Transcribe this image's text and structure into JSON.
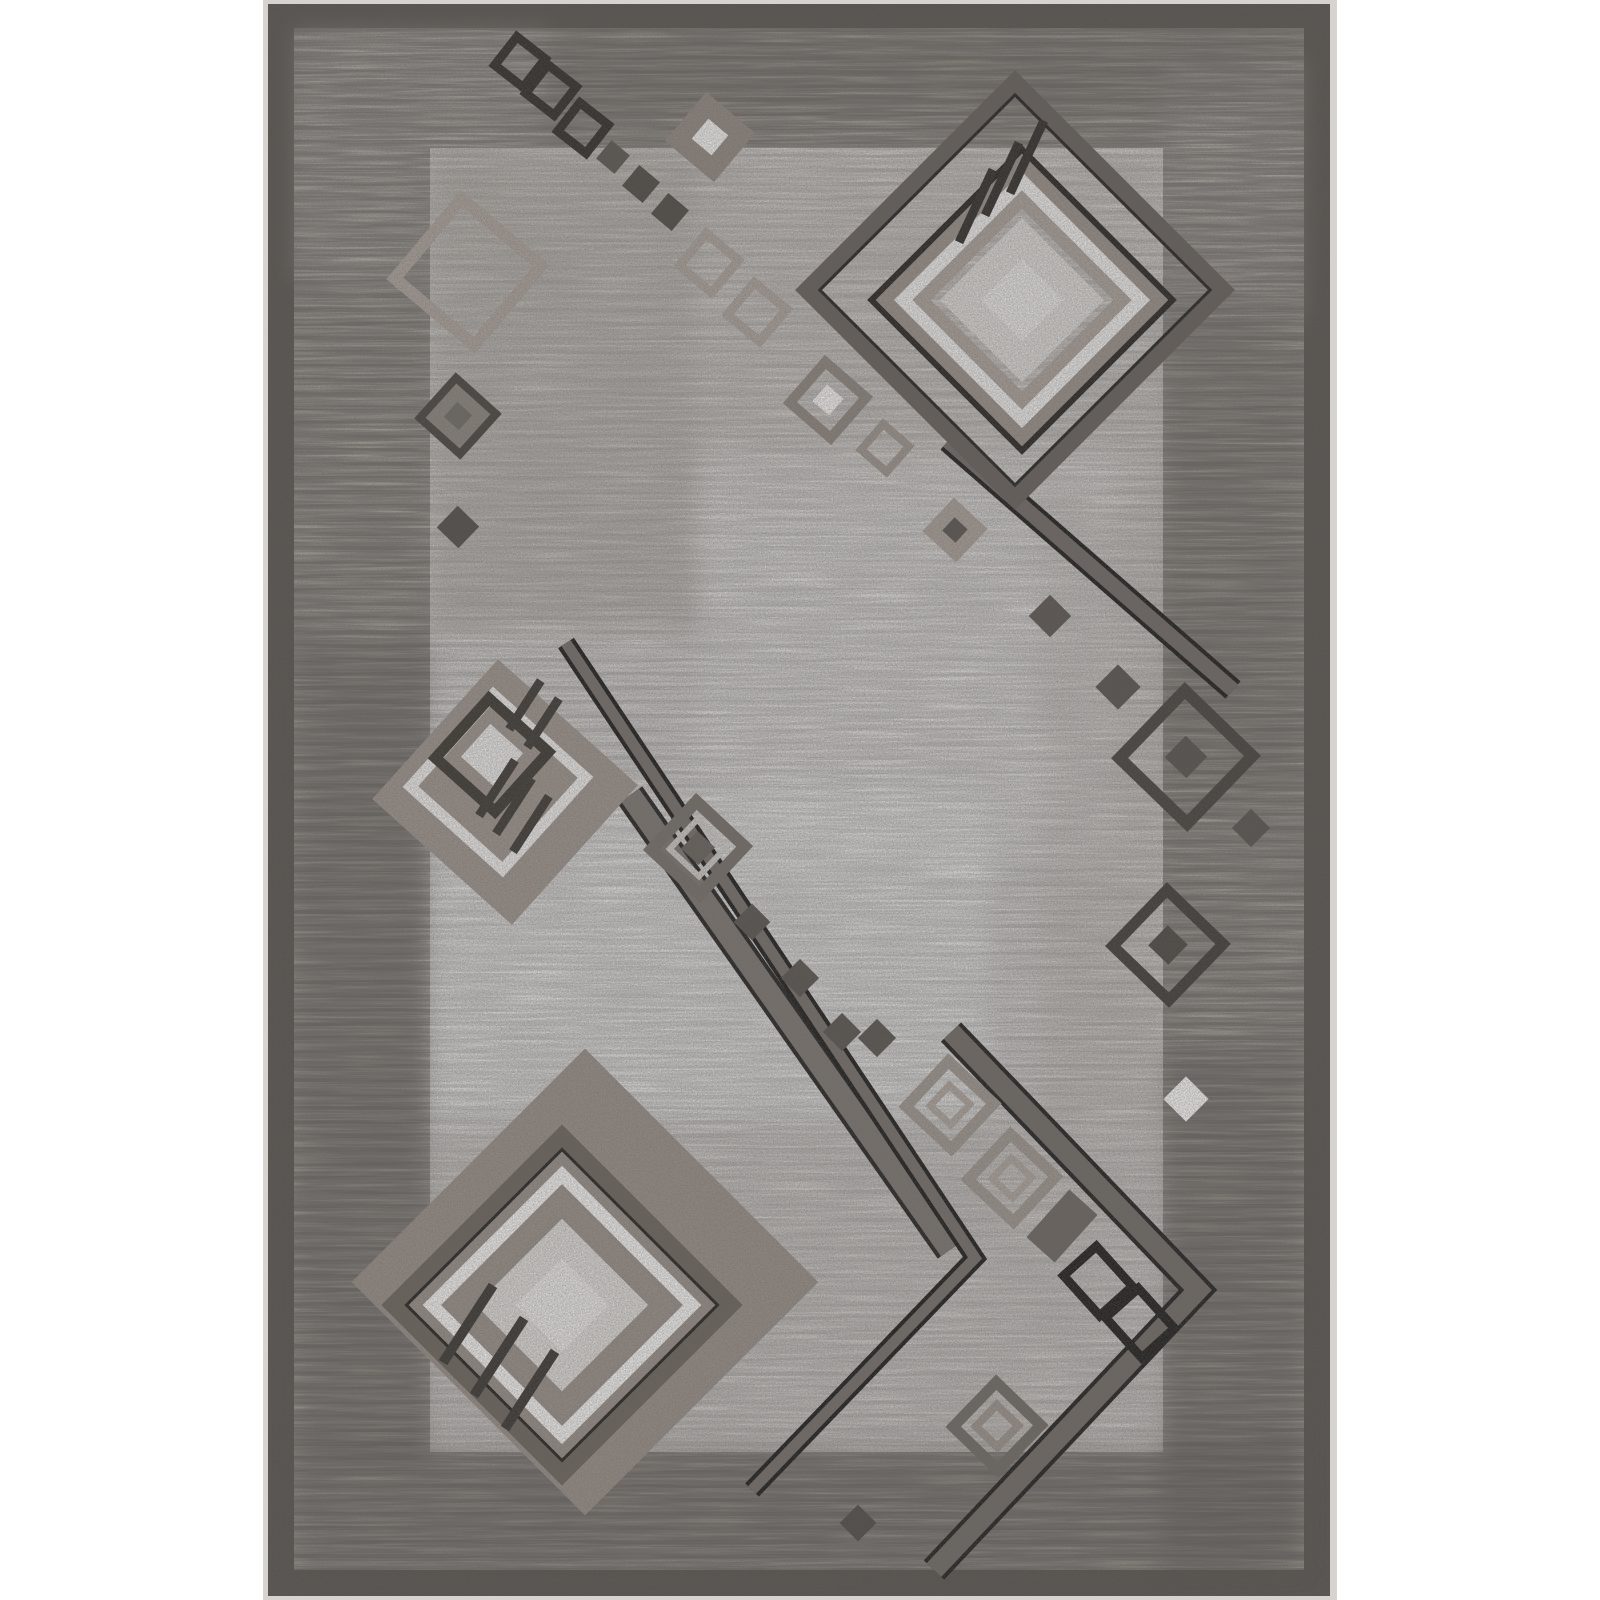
{
  "description": "Product photo of a rectangular gray and taupe area rug with a modern geometric pattern: nested concentric diamonds, chains of small squares, tick strokes and long diagonal chevron bands over a mottled light field, surrounded by a striated taupe border and dark binding edge.",
  "scene": {
    "width": 1600,
    "height": 1600,
    "palette": {
      "page_bg": "#ffffff",
      "photo_edge": "#d6d3d0",
      "binding": "#57524d",
      "border_base": "#a1988f",
      "field_base": "#dbd7d4",
      "stripe_dark": "#6f675f",
      "stripe_light": "#c9c2bc"
    },
    "layers": [
      {
        "name": "photo-edge",
        "x": 263,
        "y": 0,
        "w": 1074,
        "h": 1600,
        "fill": "#d6d3d0"
      },
      {
        "name": "binding",
        "x": 268,
        "y": 4,
        "w": 1062,
        "h": 1592,
        "fill": "#57524d"
      },
      {
        "name": "border",
        "x": 294,
        "y": 28,
        "w": 1010,
        "h": 1542,
        "fill": "#a1988f"
      },
      {
        "name": "field",
        "x": 430,
        "y": 148,
        "w": 733,
        "h": 1304,
        "fill": "#dbd7d4"
      }
    ],
    "stripes": [
      {
        "x": 294,
        "y": 28,
        "w": 1010,
        "h": 120,
        "op": 1
      },
      {
        "x": 294,
        "y": 1452,
        "w": 1010,
        "h": 118,
        "op": 1
      },
      {
        "x": 294,
        "y": 148,
        "w": 136,
        "h": 1304,
        "op": 1
      },
      {
        "x": 1163,
        "y": 148,
        "w": 141,
        "h": 1304,
        "op": 1
      },
      {
        "x": 430,
        "y": 148,
        "w": 733,
        "h": 1304,
        "op": 0.45
      }
    ],
    "patches": [
      {
        "x": 540,
        "y": 30,
        "w": 762,
        "h": 82,
        "fill": "#5f5850",
        "op": 0.28
      },
      {
        "x": 296,
        "y": 30,
        "w": 250,
        "h": 250,
        "fill": "#cfc9c4",
        "op": 0.25
      },
      {
        "x": 296,
        "y": 640,
        "w": 134,
        "h": 820,
        "fill": "#564f48",
        "op": 0.3
      },
      {
        "x": 1163,
        "y": 60,
        "w": 139,
        "h": 260,
        "fill": "#cfc9c4",
        "op": 0.22
      },
      {
        "x": 1163,
        "y": 300,
        "w": 139,
        "h": 500,
        "fill": "#5f5850",
        "op": 0.22
      },
      {
        "x": 1163,
        "y": 1050,
        "w": 139,
        "h": 520,
        "fill": "#544d46",
        "op": 0.3
      },
      {
        "x": 296,
        "y": 1440,
        "w": 1006,
        "h": 130,
        "fill": "#574f48",
        "op": 0.3
      },
      {
        "x": 430,
        "y": 148,
        "w": 270,
        "h": 480,
        "fill": "#b3aaa3",
        "op": 0.55
      },
      {
        "x": 700,
        "y": 148,
        "w": 463,
        "h": 360,
        "fill": "#c3bbb4",
        "op": 0.4
      },
      {
        "x": 700,
        "y": 450,
        "w": 420,
        "h": 420,
        "fill": "#e8e5e3",
        "op": 0.5
      },
      {
        "x": 430,
        "y": 790,
        "w": 560,
        "h": 330,
        "fill": "#f0efed",
        "op": 0.6
      },
      {
        "x": 430,
        "y": 1120,
        "w": 733,
        "h": 332,
        "fill": "#c9c3bf",
        "op": 0.45
      },
      {
        "x": 1040,
        "y": 500,
        "w": 123,
        "h": 620,
        "fill": "#b9b1aa",
        "op": 0.3
      }
    ],
    "speckle": [
      {
        "x": 294,
        "y": 28,
        "w": 1010,
        "h": 120,
        "op": 0.5
      },
      {
        "x": 294,
        "y": 1452,
        "w": 1010,
        "h": 118,
        "op": 0.5
      },
      {
        "x": 294,
        "y": 148,
        "w": 136,
        "h": 1304,
        "op": 0.5
      },
      {
        "x": 1163,
        "y": 148,
        "w": 141,
        "h": 1304,
        "op": 0.5
      },
      {
        "x": 430,
        "y": 148,
        "w": 733,
        "h": 1304,
        "op": 0.22
      }
    ],
    "grain": {
      "x": 268,
      "y": 4,
      "w": 1062,
      "h": 1592,
      "op": 0.5
    },
    "motifs": [
      {
        "k": "rect",
        "cx": 585,
        "cy": 1282,
        "w": 330,
        "h": 330,
        "rot": 45,
        "fill": "#958b84"
      },
      {
        "k": "rect",
        "cx": 562,
        "cy": 1305,
        "w": 252,
        "h": 252,
        "rot": 45,
        "stroke": "#23201d",
        "sw": 3
      },
      {
        "k": "rect",
        "cx": 562,
        "cy": 1305,
        "w": 236,
        "h": 236,
        "rot": 45,
        "stroke": "#696259",
        "sw": 19
      },
      {
        "k": "rect",
        "cx": 562,
        "cy": 1305,
        "w": 220,
        "h": 220,
        "rot": 45,
        "stroke": "#23201d",
        "sw": 3
      },
      {
        "k": "rect",
        "cx": 562,
        "cy": 1305,
        "w": 184,
        "h": 184,
        "rot": 45,
        "stroke": "#f0eeec",
        "sw": 13
      },
      {
        "k": "rect",
        "cx": 562,
        "cy": 1305,
        "w": 150,
        "h": 150,
        "rot": 45,
        "stroke": "#968c85",
        "sw": 12
      },
      {
        "k": "rect",
        "cx": 562,
        "cy": 1305,
        "w": 122,
        "h": 122,
        "rot": 45,
        "fill": "#dad6d3"
      },
      {
        "k": "rect",
        "cx": 562,
        "cy": 1305,
        "w": 66,
        "h": 66,
        "rot": 45,
        "fill": "#e7e4e2"
      },
      {
        "k": "rect",
        "cx": 468,
        "cy": 1324,
        "w": 10,
        "h": 92,
        "rot": 33,
        "fill": "#38332f"
      },
      {
        "k": "rect",
        "cx": 499,
        "cy": 1357,
        "w": 10,
        "h": 92,
        "rot": 33,
        "fill": "#38332f"
      },
      {
        "k": "rect",
        "cx": 530,
        "cy": 1390,
        "w": 10,
        "h": 92,
        "rot": 33,
        "fill": "#38332f"
      },
      {
        "k": "band",
        "pts": [
          [
            630,
            795
          ],
          [
            950,
            1250
          ]
        ],
        "w": 30,
        "cw": 22,
        "edge": "#23201f",
        "core": "#7a736d"
      },
      {
        "k": "band",
        "pts": [
          [
            951,
            1032
          ],
          [
            1198,
            1290
          ],
          [
            934,
            1570
          ]
        ],
        "w": 28,
        "cw": 20,
        "edge": "#201d1b",
        "core": "#6f6862"
      },
      {
        "k": "band",
        "pts": [
          [
            566,
            643
          ],
          [
            975,
            1258
          ],
          [
            752,
            1490
          ]
        ],
        "w": 19,
        "cw": 11,
        "edge": "#1b1917",
        "core": "#736c66"
      },
      {
        "k": "band",
        "pts": [
          [
            948,
            441
          ],
          [
            1233,
            690
          ]
        ],
        "w": 23,
        "cw": 15,
        "edge": "#1d1a18",
        "core": "#6e6762"
      },
      {
        "k": "rect",
        "cx": 505,
        "cy": 792,
        "w": 188,
        "h": 188,
        "rot": 42,
        "fill": "#9a9089"
      },
      {
        "k": "rect",
        "cx": 498,
        "cy": 782,
        "w": 124,
        "h": 124,
        "rot": 42,
        "stroke": "#eae7e5",
        "sw": 11
      },
      {
        "k": "rect",
        "cx": 492,
        "cy": 755,
        "w": 80,
        "h": 80,
        "rot": 42,
        "stroke": "#3a352f",
        "sw": 11
      },
      {
        "k": "rect",
        "cx": 492,
        "cy": 755,
        "w": 44,
        "h": 44,
        "rot": 42,
        "fill": "#e6e3e1"
      },
      {
        "k": "rect",
        "cx": 525,
        "cy": 705,
        "w": 9,
        "h": 58,
        "rot": 33,
        "fill": "#3b3631"
      },
      {
        "k": "rect",
        "cx": 543,
        "cy": 723,
        "w": 9,
        "h": 58,
        "rot": 33,
        "fill": "#3b3631"
      },
      {
        "k": "rect",
        "cx": 497,
        "cy": 788,
        "w": 9,
        "h": 66,
        "rot": 33,
        "fill": "#3b3631"
      },
      {
        "k": "rect",
        "cx": 514,
        "cy": 806,
        "w": 9,
        "h": 66,
        "rot": 33,
        "fill": "#3b3631"
      },
      {
        "k": "rect",
        "cx": 531,
        "cy": 824,
        "w": 9,
        "h": 66,
        "rot": 33,
        "fill": "#3b3631"
      },
      {
        "k": "rect",
        "cx": 698,
        "cy": 848,
        "w": 66,
        "h": 66,
        "rot": 43,
        "stroke": "#746d67",
        "sw": 12
      },
      {
        "k": "rect",
        "cx": 698,
        "cy": 848,
        "w": 40,
        "h": 40,
        "rot": 43,
        "stroke": "#cbc6c2",
        "sw": 6
      },
      {
        "k": "rect",
        "cx": 698,
        "cy": 848,
        "w": 24,
        "h": 24,
        "rot": 43,
        "fill": "#665f59"
      },
      {
        "k": "rect",
        "cx": 752,
        "cy": 922,
        "w": 26,
        "h": 26,
        "rot": 45,
        "fill": "#57514c"
      },
      {
        "k": "rect",
        "cx": 800,
        "cy": 978,
        "w": 27,
        "h": 27,
        "rot": 45,
        "fill": "#57514c"
      },
      {
        "k": "rect",
        "cx": 842,
        "cy": 1032,
        "w": 27,
        "h": 27,
        "rot": 45,
        "fill": "#57514c"
      },
      {
        "k": "rect",
        "cx": 950,
        "cy": 1105,
        "w": 62,
        "h": 62,
        "rot": 43,
        "stroke": "#9c938c",
        "sw": 11
      },
      {
        "k": "rect",
        "cx": 950,
        "cy": 1105,
        "w": 28,
        "h": 28,
        "rot": 43,
        "stroke": "#aba199",
        "sw": 7
      },
      {
        "k": "rect",
        "cx": 1012,
        "cy": 1178,
        "w": 62,
        "h": 62,
        "rot": 43,
        "stroke": "#9c938c",
        "sw": 11
      },
      {
        "k": "rect",
        "cx": 1012,
        "cy": 1178,
        "w": 28,
        "h": 28,
        "rot": 43,
        "stroke": "#aba199",
        "sw": 7
      },
      {
        "k": "rect",
        "cx": 1062,
        "cy": 1226,
        "w": 64,
        "h": 38,
        "rot": -48,
        "fill": "#6b645e"
      },
      {
        "k": "rect",
        "cx": 1098,
        "cy": 1281,
        "w": 44,
        "h": 54,
        "rot": -42,
        "stroke": "#1d1b19",
        "sw": 9
      },
      {
        "k": "rect",
        "cx": 1140,
        "cy": 1323,
        "w": 44,
        "h": 54,
        "rot": -42,
        "stroke": "#1d1b19",
        "sw": 9
      },
      {
        "k": "rect",
        "cx": 997,
        "cy": 1426,
        "w": 62,
        "h": 62,
        "rot": 44,
        "stroke": "#6f6862",
        "sw": 11
      },
      {
        "k": "rect",
        "cx": 997,
        "cy": 1426,
        "w": 30,
        "h": 30,
        "rot": 44,
        "stroke": "#9a9089",
        "sw": 8
      },
      {
        "k": "rect",
        "cx": 858,
        "cy": 1523,
        "w": 26,
        "h": 26,
        "rot": 45,
        "fill": "#4f4a45"
      },
      {
        "k": "rect",
        "cx": 1050,
        "cy": 616,
        "w": 30,
        "h": 30,
        "rot": 45,
        "fill": "#5b544f"
      },
      {
        "k": "rect",
        "cx": 1118,
        "cy": 687,
        "w": 32,
        "h": 32,
        "rot": 45,
        "fill": "#57514c"
      },
      {
        "k": "rect",
        "cx": 1186,
        "cy": 757,
        "w": 94,
        "h": 94,
        "rot": 44,
        "stroke": "#45403b",
        "sw": 12
      },
      {
        "k": "rect",
        "cx": 1186,
        "cy": 757,
        "w": 30,
        "h": 30,
        "rot": 44,
        "fill": "#55504b"
      },
      {
        "k": "rect",
        "cx": 1251,
        "cy": 828,
        "w": 27,
        "h": 27,
        "rot": 45,
        "fill": "#57514c"
      },
      {
        "k": "rect",
        "cx": 1168,
        "cy": 945,
        "w": 78,
        "h": 78,
        "rot": 44,
        "stroke": "#3f3a36",
        "sw": 11
      },
      {
        "k": "rect",
        "cx": 1168,
        "cy": 945,
        "w": 28,
        "h": 28,
        "rot": 44,
        "fill": "#4c4641"
      },
      {
        "k": "rect",
        "cx": 1186,
        "cy": 1099,
        "w": 32,
        "h": 32,
        "rot": 45,
        "fill": "#f2f0ee"
      },
      {
        "k": "rect",
        "cx": 877,
        "cy": 1038,
        "w": 27,
        "h": 27,
        "rot": 45,
        "fill": "#57514c"
      },
      {
        "k": "rect",
        "cx": 828,
        "cy": 400,
        "w": 54,
        "h": 54,
        "rot": 41,
        "stroke": "#8a817a",
        "sw": 10
      },
      {
        "k": "rect",
        "cx": 828,
        "cy": 400,
        "w": 22,
        "h": 22,
        "rot": 41,
        "fill": "#eeecea"
      },
      {
        "k": "rect",
        "cx": 885,
        "cy": 448,
        "w": 34,
        "h": 34,
        "rot": 41,
        "stroke": "#9a9089",
        "sw": 8
      },
      {
        "k": "rect",
        "cx": 955,
        "cy": 530,
        "w": 46,
        "h": 46,
        "rot": 43,
        "fill": "#a59b94"
      },
      {
        "k": "rect",
        "cx": 955,
        "cy": 530,
        "w": 18,
        "h": 18,
        "rot": 43,
        "fill": "#57514c"
      },
      {
        "k": "rect",
        "cx": 520,
        "cy": 62,
        "w": 36,
        "h": 36,
        "rot": 38,
        "stroke": "#2e2a27",
        "sw": 9
      },
      {
        "k": "rect",
        "cx": 551,
        "cy": 90,
        "w": 36,
        "h": 36,
        "rot": 38,
        "stroke": "#2e2a27",
        "sw": 9
      },
      {
        "k": "rect",
        "cx": 583,
        "cy": 128,
        "w": 36,
        "h": 36,
        "rot": 38,
        "stroke": "#2e2a27",
        "sw": 9
      },
      {
        "k": "rect",
        "cx": 613,
        "cy": 157,
        "w": 24,
        "h": 24,
        "rot": 40,
        "fill": "#5a544e"
      },
      {
        "k": "rect",
        "cx": 641,
        "cy": 184,
        "w": 27,
        "h": 27,
        "rot": 40,
        "fill": "#4e4842"
      },
      {
        "k": "rect",
        "cx": 670,
        "cy": 212,
        "w": 27,
        "h": 27,
        "rot": 40,
        "fill": "#4e4842"
      },
      {
        "k": "rect",
        "cx": 710,
        "cy": 137,
        "w": 64,
        "h": 64,
        "rot": 40,
        "fill": "#8e847d"
      },
      {
        "k": "rect",
        "cx": 710,
        "cy": 137,
        "w": 26,
        "h": 26,
        "rot": 40,
        "fill": "#edebe9"
      },
      {
        "k": "rect",
        "cx": 709,
        "cy": 263,
        "w": 42,
        "h": 42,
        "rot": 40,
        "stroke": "#a89e97",
        "sw": 9
      },
      {
        "k": "rect",
        "cx": 757,
        "cy": 312,
        "w": 42,
        "h": 42,
        "rot": 40,
        "stroke": "#a89e97",
        "sw": 9
      },
      {
        "k": "rect",
        "cx": 468,
        "cy": 272,
        "w": 104,
        "h": 104,
        "rot": 40,
        "stroke": "#a89e97",
        "sw": 12
      },
      {
        "k": "rect",
        "cx": 458,
        "cy": 416,
        "w": 54,
        "h": 54,
        "rot": 42,
        "fill": "#8a827b",
        "stroke": "#46413c",
        "sw": 8
      },
      {
        "k": "rect",
        "cx": 458,
        "cy": 416,
        "w": 20,
        "h": 20,
        "rot": 42,
        "fill": "#6e6861"
      },
      {
        "k": "rect",
        "cx": 458,
        "cy": 527,
        "w": 30,
        "h": 30,
        "rot": 44,
        "fill": "#514b46"
      },
      {
        "k": "rect",
        "cx": 1015,
        "cy": 290,
        "w": 306,
        "h": 306,
        "rot": 45,
        "stroke": "#23201e",
        "sw": 3
      },
      {
        "k": "rect",
        "cx": 1015,
        "cy": 290,
        "w": 292,
        "h": 292,
        "rot": 45,
        "stroke": "#645d58",
        "sw": 19
      },
      {
        "k": "rect",
        "cx": 1015,
        "cy": 290,
        "w": 276,
        "h": 276,
        "rot": 45,
        "stroke": "#23201e",
        "sw": 3
      },
      {
        "k": "rect",
        "cx": 1022,
        "cy": 300,
        "w": 212,
        "h": 212,
        "rot": 45,
        "stroke": "#26221f",
        "sw": 7
      },
      {
        "k": "rect",
        "cx": 1022,
        "cy": 300,
        "w": 194,
        "h": 194,
        "rot": 45,
        "stroke": "#968c85",
        "sw": 13
      },
      {
        "k": "rect",
        "cx": 1022,
        "cy": 300,
        "w": 168,
        "h": 168,
        "rot": 45,
        "stroke": "#e9e6e4",
        "sw": 13
      },
      {
        "k": "rect",
        "cx": 1022,
        "cy": 300,
        "w": 142,
        "h": 142,
        "rot": 45,
        "stroke": "#a79d96",
        "sw": 13
      },
      {
        "k": "rect",
        "cx": 1022,
        "cy": 300,
        "w": 116,
        "h": 116,
        "rot": 45,
        "fill": "#d7d3d0"
      },
      {
        "k": "rect",
        "cx": 1022,
        "cy": 300,
        "w": 58,
        "h": 58,
        "rot": 45,
        "fill": "#e3e0dd"
      },
      {
        "k": "rect",
        "cx": 976,
        "cy": 206,
        "w": 9,
        "h": 80,
        "rot": 25,
        "fill": "#2e2a26"
      },
      {
        "k": "rect",
        "cx": 1002,
        "cy": 179,
        "w": 9,
        "h": 80,
        "rot": 25,
        "fill": "#2e2a26"
      },
      {
        "k": "rect",
        "cx": 1027,
        "cy": 157,
        "w": 9,
        "h": 80,
        "rot": 25,
        "fill": "#2e2a26"
      }
    ]
  }
}
